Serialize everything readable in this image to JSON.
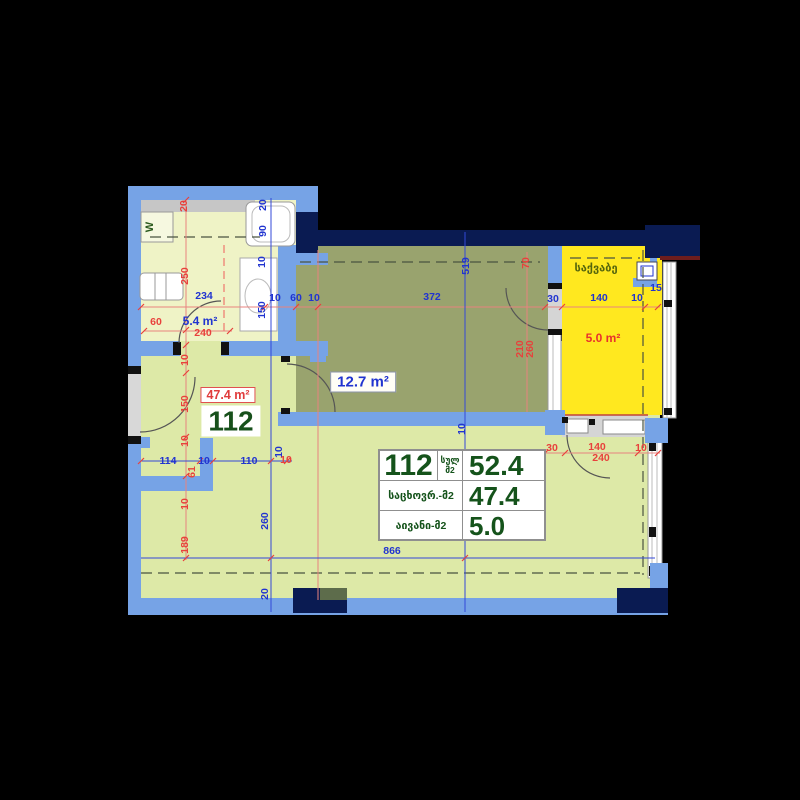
{
  "unit": {
    "number": "112",
    "areas": {
      "total": "52.4",
      "living": "47.4",
      "balcony": "5.0"
    },
    "table_labels": {
      "total_1": "სულ",
      "total_2": "მ2",
      "living": "საცხოვრ.-მ2",
      "balcony": "აივანი-მ2"
    }
  },
  "rooms": {
    "living": {
      "area_label": "47.4 m²",
      "number": "112"
    },
    "bedroom": {
      "area_label": "12.7 m²"
    },
    "bathroom": {
      "area_label": "5.4 m²"
    },
    "boiler": {
      "name": "საქვაბე",
      "area_label": "5.0 m²"
    },
    "washer_label": "W"
  },
  "colors": {
    "wall_light": "#76a3e6",
    "wall_dark": "#0a1b52",
    "floor_living": "#dde9a7",
    "floor_bathroom": "#eff3c6",
    "floor_bedroom": "#99a36e",
    "floor_boiler": "#ffe81f",
    "dim_blue": "#2134d0",
    "dim_red": "#e8413c",
    "table_text_green": "#15531b"
  },
  "dimensions": {
    "blue": [
      {
        "t": "234",
        "x": 204,
        "y": 296,
        "r": 0
      },
      {
        "t": "20",
        "x": 263,
        "y": 205,
        "r": 1
      },
      {
        "t": "90",
        "x": 263,
        "y": 231,
        "r": 1
      },
      {
        "t": "10",
        "x": 262,
        "y": 262,
        "r": 1
      },
      {
        "t": "150",
        "x": 262,
        "y": 310,
        "r": 1
      },
      {
        "t": "10",
        "x": 275,
        "y": 298,
        "r": 0
      },
      {
        "t": "60",
        "x": 296,
        "y": 298,
        "r": 0
      },
      {
        "t": "10",
        "x": 314,
        "y": 298,
        "r": 0
      },
      {
        "t": "372",
        "x": 432,
        "y": 297,
        "r": 0
      },
      {
        "t": "519",
        "x": 466,
        "y": 266,
        "r": 1
      },
      {
        "t": "30",
        "x": 553,
        "y": 299,
        "r": 0
      },
      {
        "t": "140",
        "x": 599,
        "y": 298,
        "r": 0
      },
      {
        "t": "10",
        "x": 637,
        "y": 298,
        "r": 0
      },
      {
        "t": "15",
        "x": 656,
        "y": 288,
        "r": 0
      },
      {
        "t": "10",
        "x": 462,
        "y": 429,
        "r": 1
      },
      {
        "t": "114",
        "x": 168,
        "y": 461,
        "r": 0
      },
      {
        "t": "10",
        "x": 204,
        "y": 461,
        "r": 0
      },
      {
        "t": "110",
        "x": 249,
        "y": 461,
        "r": 0
      },
      {
        "t": "10",
        "x": 279,
        "y": 452,
        "r": 1
      },
      {
        "t": "260",
        "x": 265,
        "y": 521,
        "r": 1
      },
      {
        "t": "20",
        "x": 265,
        "y": 594,
        "r": 1
      },
      {
        "t": "301",
        "x": 464,
        "y": 513,
        "r": 1
      },
      {
        "t": "866",
        "x": 392,
        "y": 551,
        "r": 0
      }
    ],
    "red": [
      {
        "t": "20",
        "x": 184,
        "y": 206,
        "r": 1
      },
      {
        "t": "250",
        "x": 185,
        "y": 276,
        "r": 1
      },
      {
        "t": "60",
        "x": 156,
        "y": 322,
        "r": 0
      },
      {
        "t": "240",
        "x": 203,
        "y": 333,
        "r": 0
      },
      {
        "t": "10",
        "x": 185,
        "y": 360,
        "r": 1
      },
      {
        "t": "150",
        "x": 185,
        "y": 404,
        "r": 1
      },
      {
        "t": "10",
        "x": 185,
        "y": 441,
        "r": 1
      },
      {
        "t": "61",
        "x": 192,
        "y": 472,
        "r": 1
      },
      {
        "t": "10",
        "x": 185,
        "y": 504,
        "r": 1
      },
      {
        "t": "189",
        "x": 185,
        "y": 545,
        "r": 1
      },
      {
        "t": "70",
        "x": 526,
        "y": 263,
        "r": 1
      },
      {
        "t": "210",
        "x": 520,
        "y": 349,
        "r": 1
      },
      {
        "t": "260",
        "x": 530,
        "y": 349,
        "r": 1
      },
      {
        "t": "30",
        "x": 552,
        "y": 448,
        "r": 0
      },
      {
        "t": "140",
        "x": 597,
        "y": 447,
        "r": 0
      },
      {
        "t": "10",
        "x": 641,
        "y": 448,
        "r": 0
      },
      {
        "t": "240",
        "x": 601,
        "y": 458,
        "r": 0
      },
      {
        "t": "10",
        "x": 286,
        "y": 460,
        "r": 0
      }
    ]
  }
}
